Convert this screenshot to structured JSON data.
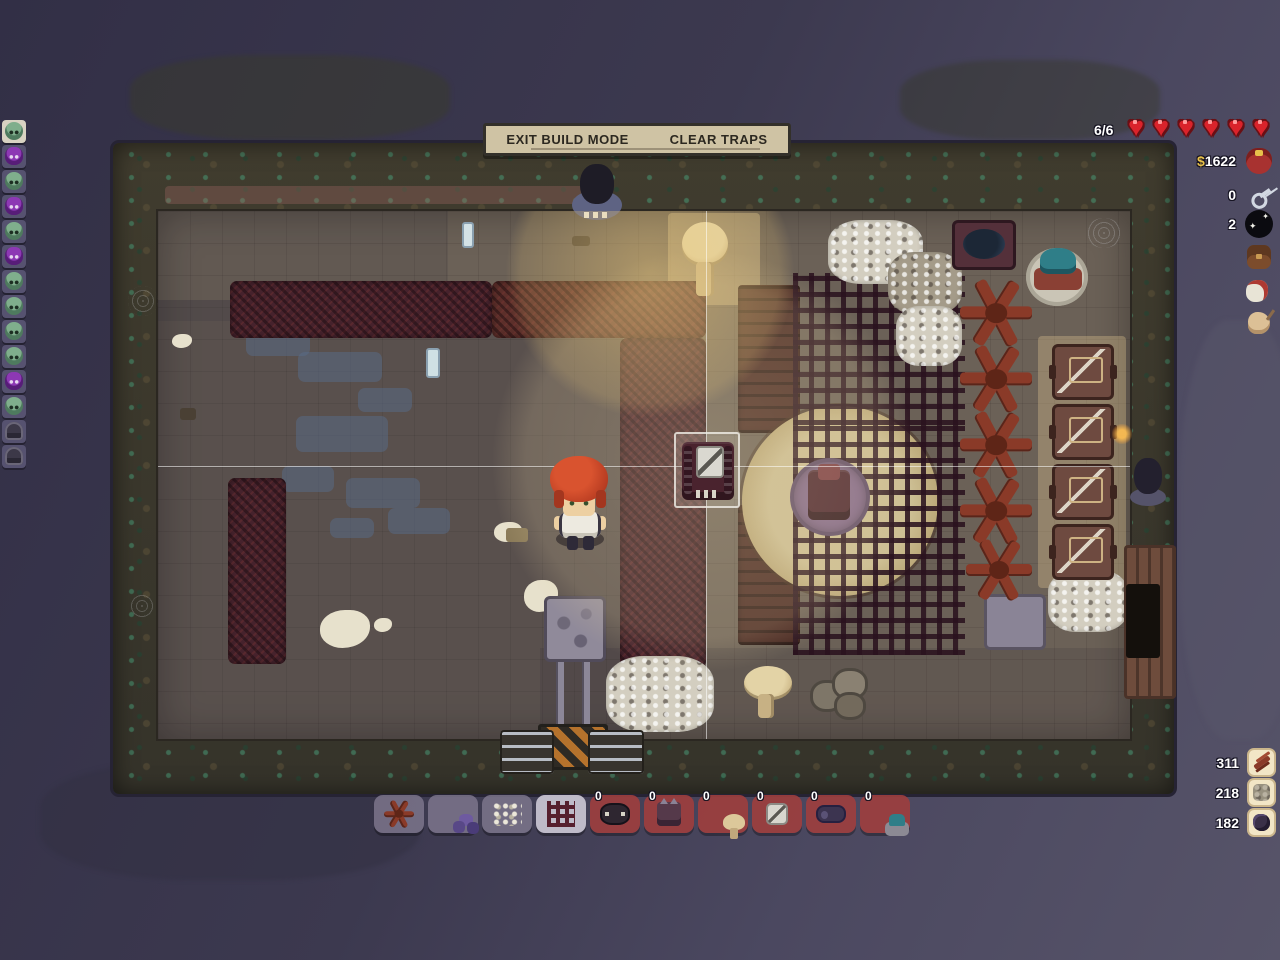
{
  "build_bar": {
    "exit_label": "EXIT BUILD MODE",
    "clear_label": "CLEAR TRAPS"
  },
  "health": {
    "label": "6/6",
    "hearts_total": 6,
    "heart_color": "#da232b"
  },
  "top_right_resources": {
    "money_symbol": "$",
    "money_amount": "1622",
    "keys_count": "0",
    "void_count": "2",
    "icons": [
      "coin-purse",
      "key",
      "void-sparkle",
      "satchel",
      "meat",
      "bait-pouch"
    ]
  },
  "bottom_right_resources": [
    {
      "icon": "branch",
      "count": "311"
    },
    {
      "icon": "gravel",
      "count": "218"
    },
    {
      "icon": "dark-rock",
      "count": "182"
    }
  ],
  "hotbar": {
    "slots": [
      {
        "icon": "spike-branches",
        "count": "",
        "state": "normal"
      },
      {
        "icon": "purple-rocks",
        "count": "",
        "state": "normal"
      },
      {
        "icon": "gravel-pile",
        "count": "",
        "state": "normal"
      },
      {
        "icon": "net-grid",
        "count": "",
        "state": "selected"
      },
      {
        "icon": "bear-trap",
        "count": "0",
        "state": "unaffordable"
      },
      {
        "icon": "spike-trap",
        "count": "0",
        "state": "unaffordable"
      },
      {
        "icon": "mushroom",
        "count": "0",
        "state": "unaffordable"
      },
      {
        "icon": "box-trap",
        "count": "0",
        "state": "unaffordable"
      },
      {
        "icon": "log-trap",
        "count": "0",
        "state": "unaffordable"
      },
      {
        "icon": "turret",
        "count": "0",
        "state": "unaffordable"
      }
    ]
  },
  "monster_sidebar": {
    "slots": [
      {
        "type": "green-monster",
        "selected": true
      },
      {
        "type": "purple-spider",
        "selected": false
      },
      {
        "type": "green-monster",
        "selected": false
      },
      {
        "type": "purple-spider",
        "selected": false
      },
      {
        "type": "green-monster",
        "selected": false
      },
      {
        "type": "purple-spider",
        "selected": false
      },
      {
        "type": "green-monster",
        "selected": false
      },
      {
        "type": "green-monster",
        "selected": false
      },
      {
        "type": "green-monster",
        "selected": false
      },
      {
        "type": "green-monster",
        "selected": false
      },
      {
        "type": "purple-spider",
        "selected": false
      },
      {
        "type": "green-monster",
        "selected": false
      },
      {
        "type": "hooded-ghost",
        "selected": false
      },
      {
        "type": "hooded-ghost",
        "selected": false
      }
    ]
  },
  "map_objects": [
    "player-character",
    "placement-cursor",
    "placed-trap",
    "round-rug",
    "rug-center-trap",
    "top-wall-statue",
    "right-wall-statue",
    "lit-mushroom",
    "bottom-mushroom",
    "rock-pile",
    "log-trap-machine",
    "tesla-turret",
    "spike-branch-row",
    "crate-column",
    "right-wooden-door",
    "stone-platform",
    "hazard-entrance",
    "net-grid-floor",
    "thorn-walls",
    "gravel-patches",
    "blue-floor-stains",
    "bone-splats",
    "glass-bottles"
  ],
  "colors": {
    "heart_red": "#da232b",
    "money_gold": "#e9c24a",
    "panel_tan": "#cfc3a4",
    "hotbar_red": "#9c3e3e",
    "selected_slot": "#c6c2d0",
    "rug_tan": "#cdbf94"
  }
}
